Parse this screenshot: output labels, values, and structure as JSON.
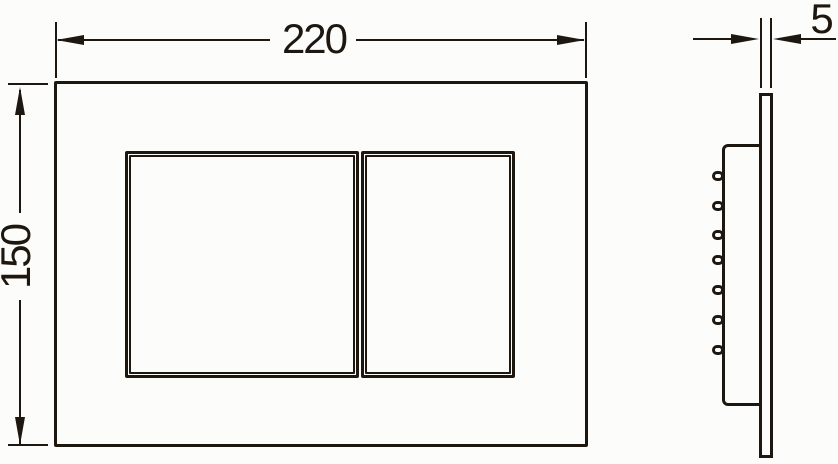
{
  "colors": {
    "line": "#1e1710",
    "background": "#fcfcfa"
  },
  "dimensions": {
    "width_label": "220",
    "height_label": "150",
    "depth_label": "5"
  }
}
